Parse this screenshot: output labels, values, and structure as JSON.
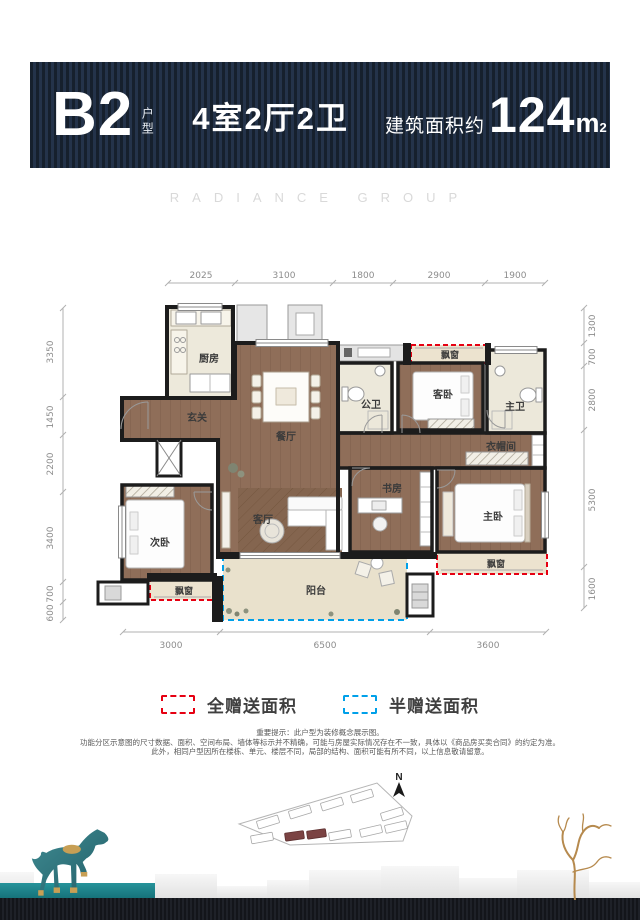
{
  "header": {
    "plan_code": "B2",
    "plan_type_label": "户型",
    "rooms_summary": "4室2厅2卫",
    "area_prefix": "建筑面积约",
    "area_value": "124",
    "area_unit": "m",
    "area_sup": "2"
  },
  "watermark": "RADIANCE GROUP",
  "floorplan": {
    "dims_top": [
      "2025",
      "3100",
      "1800",
      "2900",
      "1900"
    ],
    "dims_left": [
      "3350",
      "1450",
      "2200",
      "3400",
      "700",
      "600"
    ],
    "dims_right": [
      "1300",
      "700",
      "2800",
      "5300",
      "1600"
    ],
    "dims_bottom": [
      "3000",
      "6500",
      "3600"
    ],
    "rooms": {
      "kitchen": "厨房",
      "entry": "玄关",
      "dining": "餐厅",
      "public_bath": "公卫",
      "guest_bedroom": "客卧",
      "master_bath": "主卫",
      "cloakroom": "衣帽间",
      "study": "书房",
      "master_bedroom": "主卧",
      "living": "客厅",
      "second_bedroom": "次卧",
      "balcony": "阳台",
      "bay_window_top": "飘窗",
      "bay_window_master": "飘窗",
      "bay_window_second": "飘窗"
    }
  },
  "legend": {
    "full_gift_label": "全赠送面积",
    "full_gift_color": "#e60012",
    "half_gift_label": "半赠送面积",
    "half_gift_color": "#00a0e9"
  },
  "disclaimer": {
    "line1": "重要提示：此户型为装修概念展示图。",
    "line2": "功能分区示意图的尺寸数据、面积、空间布局、墙体等标示并不精确，可能与房屋实际情况存在不一致，具体以《商品房买卖合同》的约定为准。",
    "line3": "此外，相同户型因所在楼栋、单元、楼层不同，局部的结构、面积可能有所不同，以上信息敬请留意。"
  },
  "siteplan": {
    "north_label": "N",
    "highlight_color": "#7b4343"
  }
}
